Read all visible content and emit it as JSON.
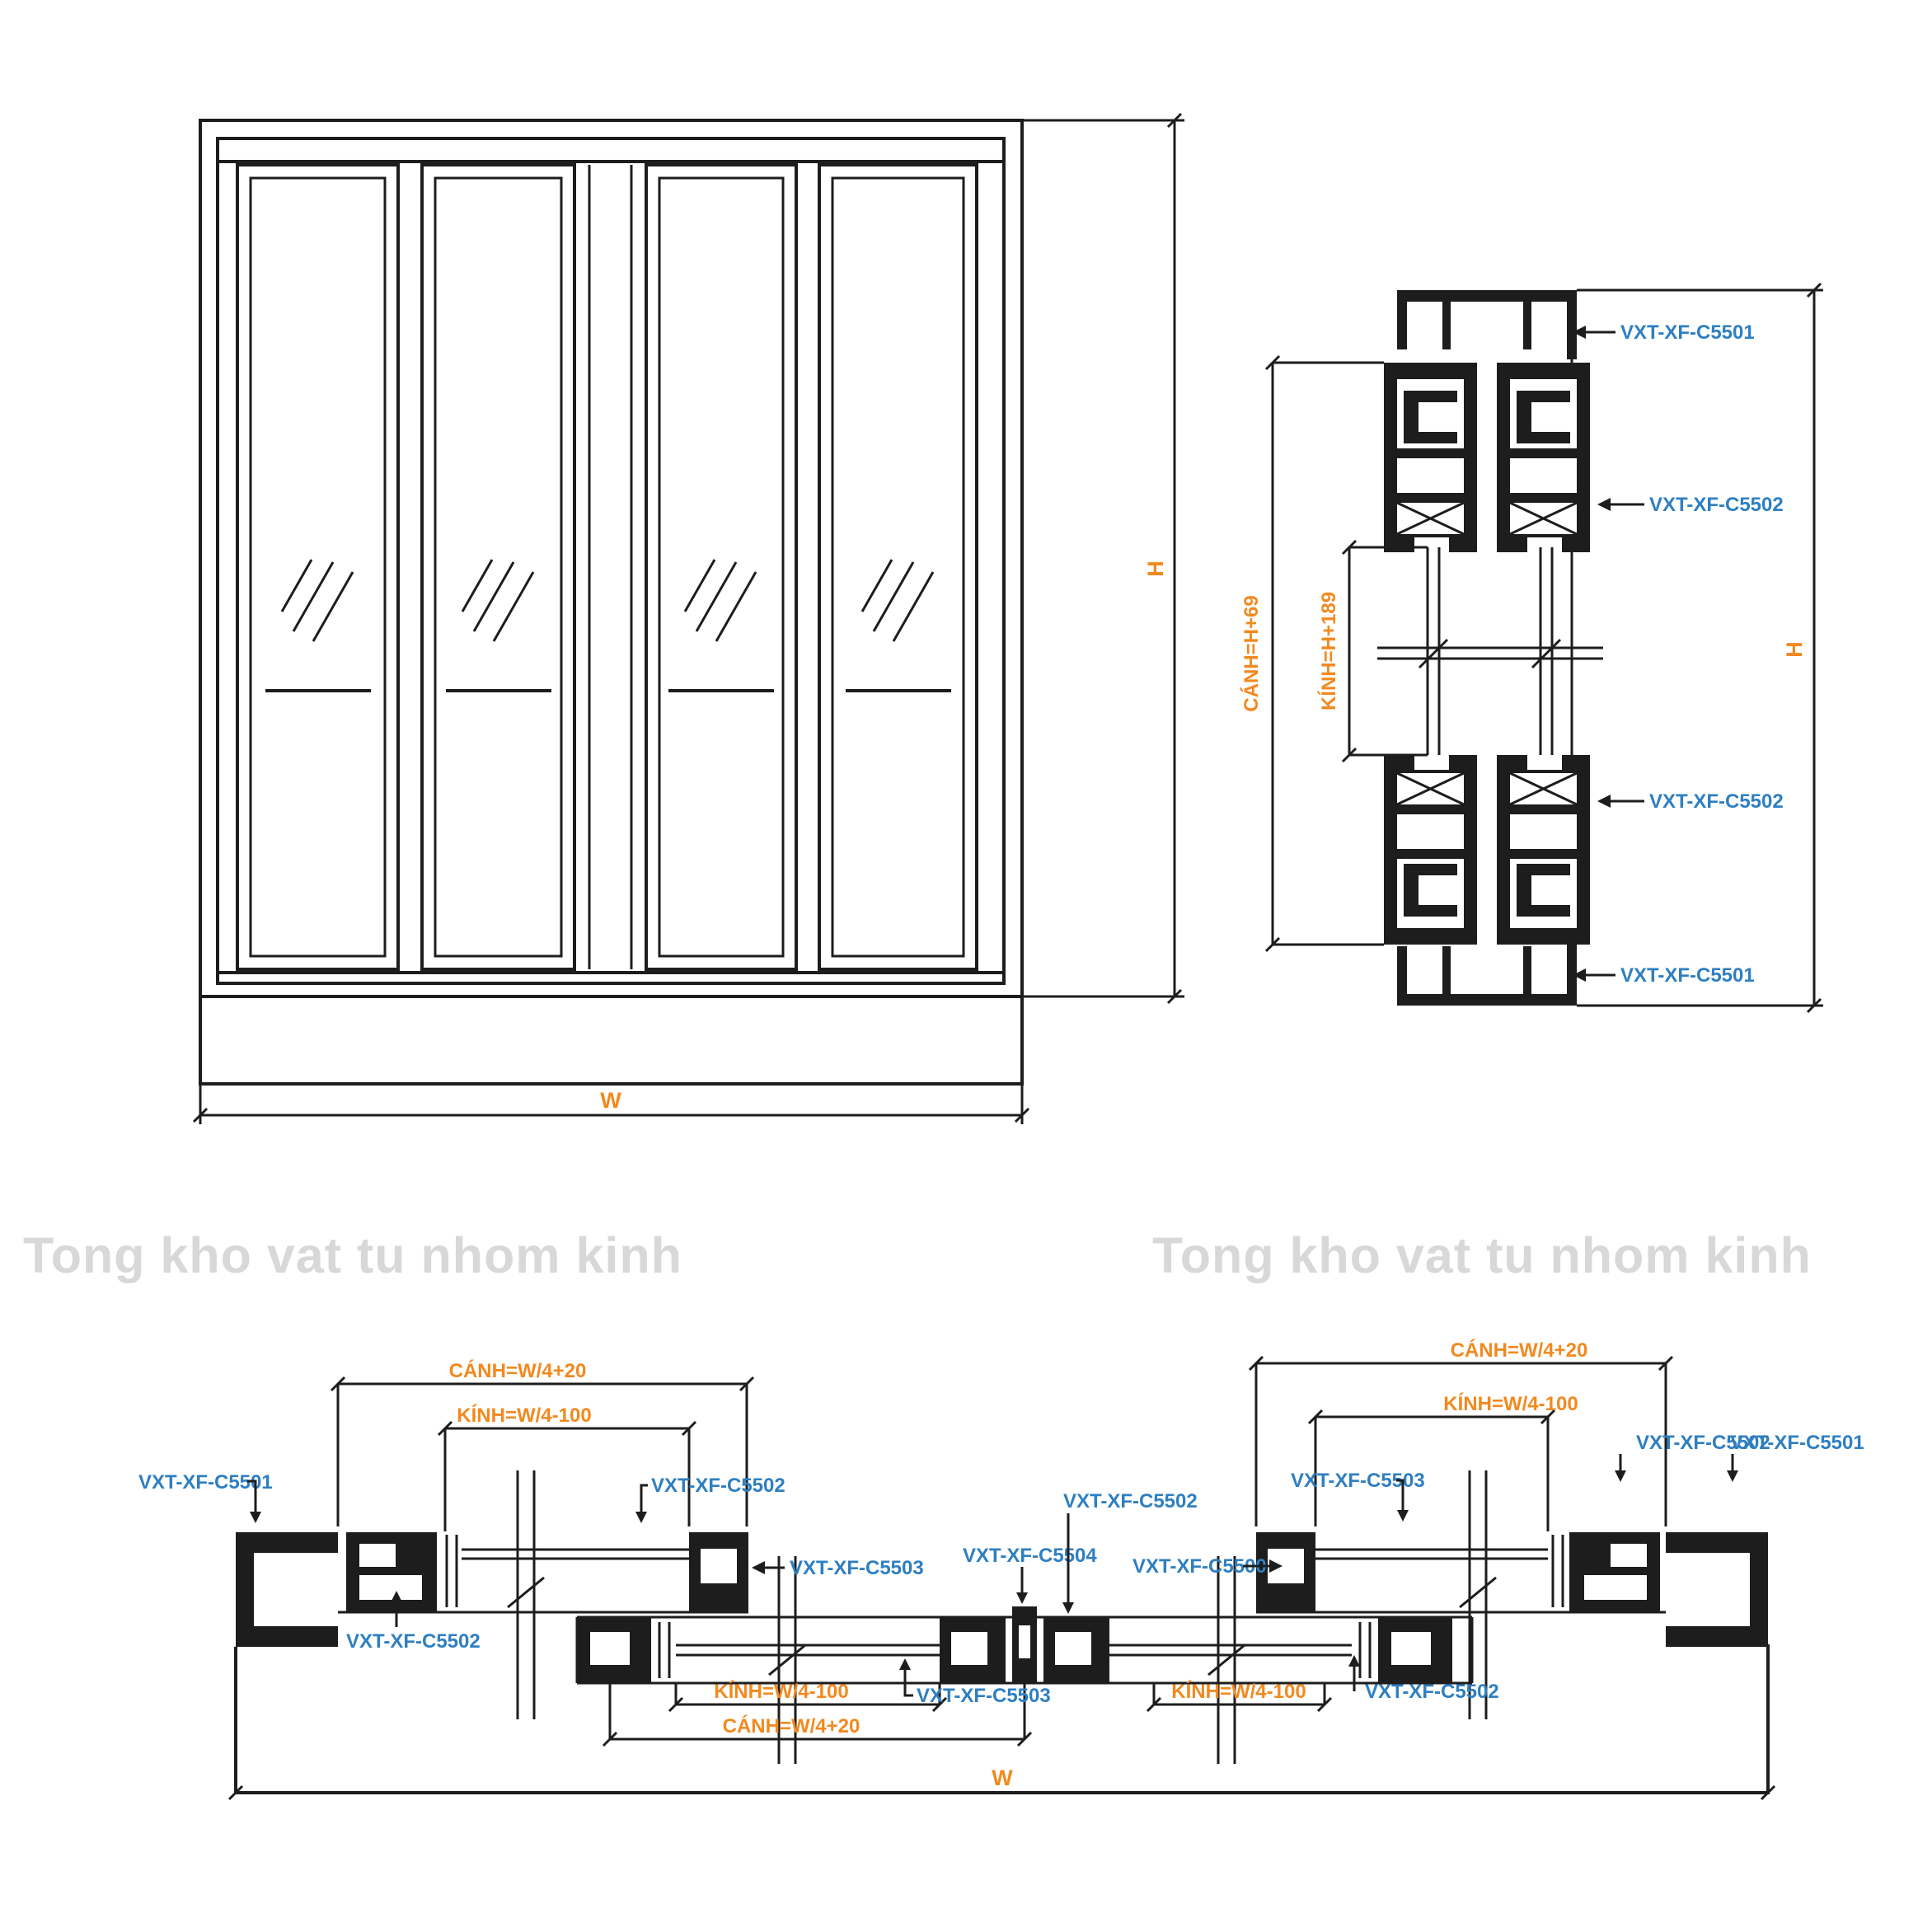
{
  "colors": {
    "line": "#1d1d1d",
    "label_blue": "#2e7fc1",
    "dim_orange": "#f2891f",
    "watermark_gray": "#d8d8d8"
  },
  "watermark": {
    "left": "Tong kho vat tu nhom kinh",
    "right": "Tong kho vat tu nhom kinh"
  },
  "elevation": {
    "dim_height": "H",
    "dim_width": "W"
  },
  "vertical_section": {
    "label_top_frame": "VXT-XF-C5501",
    "label_top_sash": "VXT-XF-C5502",
    "label_bottom_sash": "VXT-XF-C5502",
    "label_bottom_frame": "VXT-XF-C5501",
    "dim_sash": "CÁNH=H+69",
    "dim_glass": "KÍNH=H+189",
    "dim_height": "H"
  },
  "horizontal_section": {
    "dim_sash_left": "CÁNH=W/4+20",
    "dim_glass_left": "KÍNH=W/4-100",
    "dim_sash_right": "CÁNH=W/4+20",
    "dim_glass_right": "KÍNH=W/4-100",
    "dim_glass_center_left": "KÍNH=W/4-100",
    "dim_sash_center_left": "CÁNH=W/4+20",
    "dim_glass_center_right": "KÍNH=W/4-100",
    "dim_width": "W",
    "label_left_frame": "VXT-XF-C5501",
    "label_left_glazing": "VXT-XF-C5502",
    "label_left_interlock": "VXT-XF-C5503",
    "label_center_hook": "VXT-XF-C5504",
    "label_center_sash": "VXT-XF-C5502",
    "label_center_track": "VXT-XF-C5500",
    "label_right_interlock": "VXT-XF-C5503",
    "label_right_sash": "VXT-XF-C5502",
    "label_right_frame": "VXT-XF-C5501",
    "label_bottom_left_sash": "VXT-XF-C5502",
    "label_bottom_interlock": "VXT-XF-C5503",
    "label_bottom_right_sash": "VXT-XF-C5502"
  }
}
